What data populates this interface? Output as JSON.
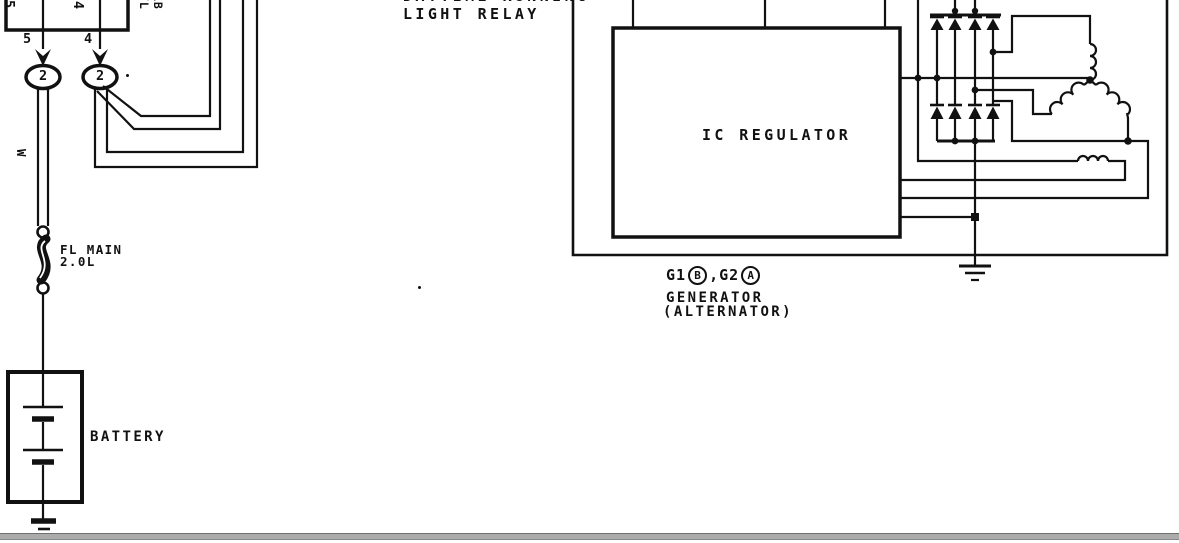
{
  "page": {
    "bg": "#ffffff",
    "ink": "#111111",
    "rule_color": "#ababab"
  },
  "relay_block": {
    "pin_inner_left": "5",
    "pin_inner_right": "4",
    "pin_outer_left": "5",
    "pin_outer_right": "4",
    "connector_left": "2",
    "connector_right": "2",
    "side_label_a": "FL",
    "side_label_b": "LB"
  },
  "power_feed": {
    "wire_color": "W",
    "fusible_link_line1": "FL MAIN",
    "fusible_link_line2": "2.0L",
    "battery_label": "BATTERY"
  },
  "drl_relay": {
    "line1": "DAYTIME RUNNING",
    "line2": "LIGHT RELAY"
  },
  "generator": {
    "ic_regulator_label": "IC REGULATOR",
    "code_g1": "G1",
    "code_b": "B",
    "code_comma": ",",
    "code_g2": "G2",
    "code_a": "A",
    "name_line1": "GENERATOR",
    "name_line2": "(ALTERNATOR)"
  }
}
